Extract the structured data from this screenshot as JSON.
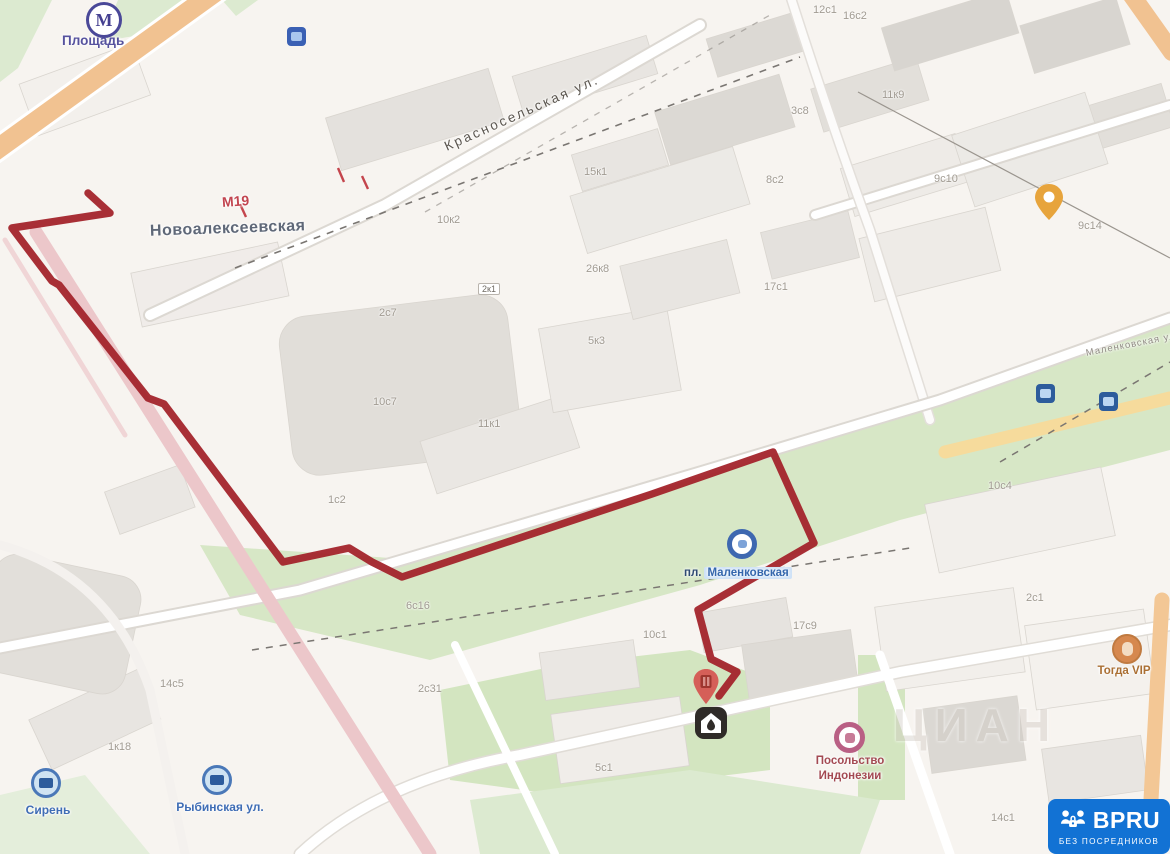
{
  "map": {
    "colors": {
      "route": "#a3242b",
      "badge_bg": "#1272d4",
      "green": "#dcead0",
      "road_orange": "#f1c291",
      "road_yellow": "#f6db9c",
      "road_pink": "#ecc7ca"
    },
    "route": {
      "color": "#a3242b",
      "points": "88,193 110,213 12,228 52,281 59,285 148,398 164,404 283,562 349,548 372,562 402,577 652,494 773,452 814,543 698,610 711,659 737,672 719,696"
    },
    "streets": {
      "metro_name": "Площадь",
      "metro_letter": "М",
      "main_street": "Новоалексеевская",
      "highway_badge": "М19",
      "diagonal_street": "Красносельская ул.",
      "right_street": "Маленковская ул.",
      "station_prefix": "пл.",
      "station_name": "Маленковская"
    },
    "stops": {
      "left": "Сирень",
      "right": "Рыбинская ул."
    },
    "poi": {
      "pink_line1": "Посольство",
      "pink_line2": "Индонезии",
      "orange": "Тогда VIP"
    },
    "watermark": "ЦИАН",
    "house_numbers": [
      {
        "t": "10к2"
      },
      {
        "t": "15к1"
      },
      {
        "t": "26к8"
      },
      {
        "t": "8с2"
      },
      {
        "t": "17с1"
      },
      {
        "t": "3с8"
      },
      {
        "t": "11к9"
      },
      {
        "t": "9с10"
      },
      {
        "t": "9с14"
      },
      {
        "t": "12с1"
      },
      {
        "t": "2с7"
      },
      {
        "t": "10с7"
      },
      {
        "t": "11к1"
      },
      {
        "t": "5к3"
      },
      {
        "t": "1с2"
      },
      {
        "t": "6с16"
      },
      {
        "t": "2с31"
      },
      {
        "t": "10с1"
      },
      {
        "t": "17с9"
      },
      {
        "t": "5с1"
      },
      {
        "t": "1к18"
      },
      {
        "t": "14с5"
      },
      {
        "t": "14с1"
      },
      {
        "t": "10с4"
      },
      {
        "t": "2с1"
      },
      {
        "t": "2к1"
      },
      {
        "t": "16с2"
      }
    ]
  },
  "badge": {
    "title": "BPRU",
    "subtitle": "БЕЗ ПОСРЕДНИКОВ"
  }
}
